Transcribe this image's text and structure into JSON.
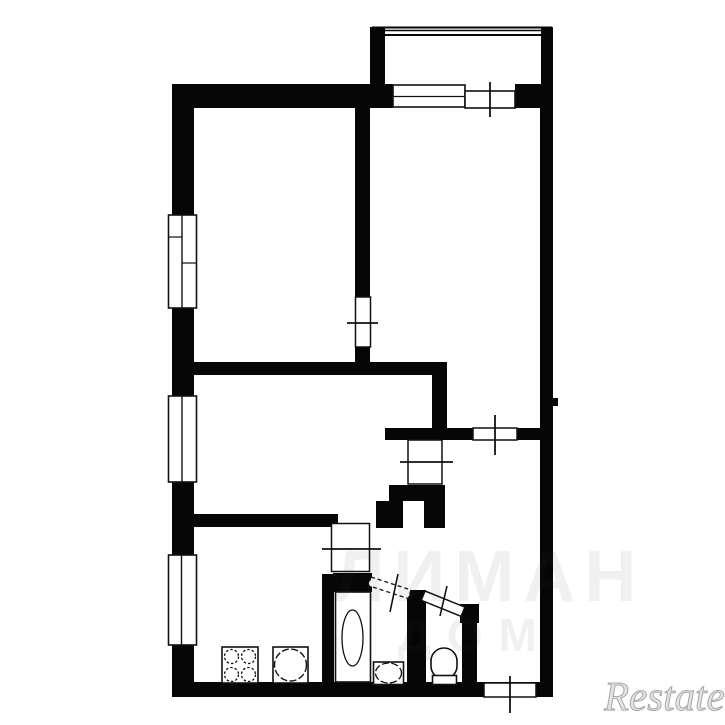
{
  "canvas": {
    "width": 725,
    "height": 725,
    "background": "#ffffff",
    "ink": "#060606",
    "line": "#111111"
  },
  "watermarks": {
    "center_line1": "ЛИМАН",
    "center_line2": "ДОМ",
    "logo": "Restate"
  },
  "plan": {
    "shapes": [
      {
        "name": "top-wall-left",
        "kind": "rect",
        "x": 172,
        "y": 84,
        "w": 221,
        "h": 24,
        "fill": "#060606"
      },
      {
        "name": "top-wall-right",
        "kind": "rect",
        "x": 515,
        "y": 84,
        "w": 38,
        "h": 24,
        "fill": "#060606"
      },
      {
        "name": "left-wall-upper",
        "kind": "rect",
        "x": 172,
        "y": 84,
        "w": 22,
        "h": 132,
        "fill": "#060606"
      },
      {
        "name": "left-wall-mid1",
        "kind": "rect",
        "x": 172,
        "y": 307,
        "w": 22,
        "h": 90,
        "fill": "#060606"
      },
      {
        "name": "left-wall-mid2",
        "kind": "rect",
        "x": 172,
        "y": 481,
        "w": 22,
        "h": 75,
        "fill": "#060606"
      },
      {
        "name": "left-wall-lower",
        "kind": "rect",
        "x": 172,
        "y": 644,
        "w": 22,
        "h": 53,
        "fill": "#060606"
      },
      {
        "name": "bottom-wall",
        "kind": "rect",
        "x": 172,
        "y": 682,
        "w": 381,
        "h": 15,
        "fill": "#060606"
      },
      {
        "name": "right-wall",
        "kind": "rect",
        "x": 540,
        "y": 84,
        "w": 13,
        "h": 598,
        "fill": "#060606"
      },
      {
        "name": "right-wall-nub",
        "kind": "rect",
        "x": 553,
        "y": 398,
        "w": 5,
        "h": 8,
        "fill": "#060606"
      },
      {
        "name": "balcony-wall-left",
        "kind": "rect",
        "x": 370,
        "y": 27,
        "w": 15,
        "h": 58,
        "fill": "#060606"
      },
      {
        "name": "balcony-wall-right",
        "kind": "rect",
        "x": 541,
        "y": 27,
        "w": 12,
        "h": 58,
        "fill": "#060606"
      },
      {
        "name": "bedroom-divider-wall",
        "kind": "rect",
        "x": 355,
        "y": 108,
        "w": 15,
        "h": 189,
        "fill": "#060606"
      },
      {
        "name": "bedroom-divider-stub",
        "kind": "rect",
        "x": 355,
        "y": 347,
        "w": 15,
        "h": 16,
        "fill": "#060606"
      },
      {
        "name": "hall-top-wall",
        "kind": "rect",
        "x": 193,
        "y": 362,
        "w": 254,
        "h": 13,
        "fill": "#060606"
      },
      {
        "name": "hall-vertical-wall",
        "kind": "rect",
        "x": 432,
        "y": 375,
        "w": 15,
        "h": 53,
        "fill": "#060606"
      },
      {
        "name": "hall-lower-wall-left",
        "kind": "rect",
        "x": 385,
        "y": 428,
        "w": 88,
        "h": 12,
        "fill": "#060606"
      },
      {
        "name": "hall-lower-wall-right",
        "kind": "rect",
        "x": 517,
        "y": 428,
        "w": 36,
        "h": 12,
        "fill": "#060606"
      },
      {
        "name": "corridor-wall",
        "kind": "rect",
        "x": 193,
        "y": 514,
        "w": 145,
        "h": 13,
        "fill": "#060606"
      },
      {
        "name": "duct-block",
        "kind": "rect",
        "x": 389,
        "y": 485,
        "w": 56,
        "h": 16,
        "fill": "#060606"
      },
      {
        "name": "duct-leg-left",
        "kind": "rect",
        "x": 376,
        "y": 501,
        "w": 27,
        "h": 27,
        "fill": "#060606"
      },
      {
        "name": "duct-leg-right",
        "kind": "rect",
        "x": 424,
        "y": 501,
        "w": 21,
        "h": 27,
        "fill": "#060606"
      },
      {
        "name": "kitchen-divider-wall",
        "kind": "rect",
        "x": 322,
        "y": 574,
        "w": 12,
        "h": 123,
        "fill": "#060606"
      },
      {
        "name": "bathroom-top-wall",
        "kind": "rect",
        "x": 333,
        "y": 573,
        "w": 39,
        "h": 19,
        "fill": "#060606"
      },
      {
        "name": "wc-left-wall",
        "kind": "rect",
        "x": 407,
        "y": 590,
        "w": 19,
        "h": 107,
        "fill": "#060606"
      },
      {
        "name": "wc-corner-block",
        "kind": "rect",
        "x": 460,
        "y": 604,
        "w": 19,
        "h": 19,
        "fill": "#060606"
      },
      {
        "name": "wc-right-wall",
        "kind": "rect",
        "x": 462,
        "y": 622,
        "w": 15,
        "h": 75,
        "fill": "#060606"
      },
      {
        "name": "balcony-rail-line",
        "kind": "line",
        "x1": 372,
        "y1": 27.5,
        "x2": 552,
        "y2": 27.5,
        "stroke": "#060606",
        "sw": 2
      },
      {
        "name": "balcony-rail-line",
        "kind": "line",
        "x1": 372,
        "y1": 30.5,
        "x2": 552,
        "y2": 30.5,
        "stroke": "#060606",
        "sw": 1.4
      },
      {
        "name": "balcony-rail-line",
        "kind": "line",
        "x1": 372,
        "y1": 35,
        "x2": 552,
        "y2": 35,
        "stroke": "#060606",
        "sw": 2
      },
      {
        "name": "window-left-1",
        "kind": "rect",
        "x": 168.5,
        "y": 215,
        "w": 28,
        "h": 93,
        "fill": "#ffffff",
        "stroke": "#111111",
        "sw": 1.6
      },
      {
        "name": "window-left-1-divider",
        "kind": "line",
        "x1": 182,
        "y1": 215,
        "x2": 182,
        "y2": 308,
        "stroke": "#111111",
        "sw": 1.4
      },
      {
        "name": "window-left-1-sash",
        "kind": "line",
        "x1": 168.5,
        "y1": 237,
        "x2": 182,
        "y2": 237,
        "stroke": "#111111",
        "sw": 1.2
      },
      {
        "name": "window-left-1-sash",
        "kind": "line",
        "x1": 182,
        "y1": 263,
        "x2": 196.5,
        "y2": 263,
        "stroke": "#111111",
        "sw": 1.2
      },
      {
        "name": "window-left-2",
        "kind": "rect",
        "x": 168.5,
        "y": 396,
        "w": 28,
        "h": 86,
        "fill": "#ffffff",
        "stroke": "#111111",
        "sw": 1.6
      },
      {
        "name": "window-left-2-divider",
        "kind": "line",
        "x1": 182,
        "y1": 396,
        "x2": 182,
        "y2": 482,
        "stroke": "#111111",
        "sw": 1.4
      },
      {
        "name": "window-left-3",
        "kind": "rect",
        "x": 168.5,
        "y": 555,
        "w": 28,
        "h": 90,
        "fill": "#ffffff",
        "stroke": "#111111",
        "sw": 1.6
      },
      {
        "name": "window-left-3-divider",
        "kind": "line",
        "x1": 181.5,
        "y1": 555,
        "x2": 181.5,
        "y2": 645,
        "stroke": "#111111",
        "sw": 1.4
      },
      {
        "name": "balcony-window",
        "kind": "rect",
        "x": 393,
        "y": 85,
        "w": 72,
        "h": 22,
        "fill": "#ffffff",
        "stroke": "#111111",
        "sw": 1.6
      },
      {
        "name": "balcony-window-midline",
        "kind": "line",
        "x1": 393,
        "y1": 96.5,
        "x2": 465,
        "y2": 96.5,
        "stroke": "#111111",
        "sw": 1.3
      },
      {
        "name": "balcony-window-side",
        "kind": "rect",
        "x": 465,
        "y": 91,
        "w": 50,
        "h": 17,
        "fill": "#ffffff",
        "stroke": "#111111",
        "sw": 1.6
      },
      {
        "name": "bedroom-door",
        "kind": "rect",
        "x": 355.5,
        "y": 297,
        "w": 15,
        "h": 50,
        "fill": "#ffffff",
        "stroke": "#111111",
        "sw": 1.5
      },
      {
        "name": "hall-door",
        "kind": "rect",
        "x": 473,
        "y": 428,
        "w": 44,
        "h": 12,
        "fill": "#ffffff",
        "stroke": "#111111",
        "sw": 1.5
      },
      {
        "name": "room-door",
        "kind": "rect",
        "x": 408,
        "y": 440,
        "w": 34,
        "h": 44,
        "fill": "#ffffff",
        "stroke": "#111111",
        "sw": 1.5
      },
      {
        "name": "kitchen-door",
        "kind": "rect",
        "x": 331.5,
        "y": 523.5,
        "w": 38,
        "h": 48,
        "fill": "#ffffff",
        "stroke": "#111111",
        "sw": 1.5
      },
      {
        "name": "entry-door",
        "kind": "rect",
        "x": 484,
        "y": 683,
        "w": 52,
        "h": 14,
        "fill": "#ffffff",
        "stroke": "#111111",
        "sw": 1.5
      },
      {
        "name": "bathroom-door-leaf",
        "kind": "rect",
        "x": 371,
        "y": 577,
        "w": 42,
        "h": 9,
        "fill": "#ffffff",
        "stroke": "#111111",
        "sw": 1.3,
        "dash": "4,3",
        "rot": 18
      },
      {
        "name": "wc-door-leaf",
        "kind": "rect",
        "x": 425,
        "y": 591,
        "w": 43,
        "h": 10,
        "fill": "#ffffff",
        "stroke": "#111111",
        "sw": 1.5,
        "rot": 22
      },
      {
        "name": "opening-tick",
        "kind": "line",
        "x1": 490,
        "y1": 82,
        "x2": 490,
        "y2": 117,
        "stroke": "#111111",
        "sw": 1.8
      },
      {
        "name": "opening-tick",
        "kind": "line",
        "x1": 347,
        "y1": 323,
        "x2": 378,
        "y2": 323,
        "stroke": "#111111",
        "sw": 1.8
      },
      {
        "name": "opening-tick",
        "kind": "line",
        "x1": 495,
        "y1": 415,
        "x2": 495,
        "y2": 455,
        "stroke": "#111111",
        "sw": 1.8
      },
      {
        "name": "opening-tick",
        "kind": "line",
        "x1": 400,
        "y1": 462,
        "x2": 453,
        "y2": 462,
        "stroke": "#111111",
        "sw": 1.8
      },
      {
        "name": "opening-tick",
        "kind": "line",
        "x1": 322,
        "y1": 549,
        "x2": 381,
        "y2": 549,
        "stroke": "#111111",
        "sw": 1.8
      },
      {
        "name": "opening-tick",
        "kind": "line",
        "x1": 510,
        "y1": 676,
        "x2": 510,
        "y2": 713,
        "stroke": "#111111",
        "sw": 1.8
      },
      {
        "name": "opening-tick",
        "kind": "line",
        "x1": 398,
        "y1": 574,
        "x2": 390,
        "y2": 612,
        "stroke": "#111111",
        "sw": 1.6
      },
      {
        "name": "opening-tick",
        "kind": "line",
        "x1": 447,
        "y1": 586,
        "x2": 440,
        "y2": 616,
        "stroke": "#111111",
        "sw": 1.6
      },
      {
        "name": "stove",
        "kind": "rect",
        "x": 222,
        "y": 647,
        "w": 36,
        "h": 36,
        "fill": "#ffffff",
        "stroke": "#111111",
        "sw": 1.6
      },
      {
        "name": "stove-burner",
        "kind": "circle",
        "cx": 231.5,
        "cy": 656.5,
        "r": 7,
        "stroke": "#111111",
        "sw": 1.3,
        "dash": "2.5,2"
      },
      {
        "name": "stove-burner",
        "kind": "circle",
        "cx": 248.5,
        "cy": 656.5,
        "r": 7,
        "stroke": "#111111",
        "sw": 1.3,
        "dash": "2.5,2"
      },
      {
        "name": "stove-burner",
        "kind": "circle",
        "cx": 231.5,
        "cy": 674.5,
        "r": 7,
        "stroke": "#111111",
        "sw": 1.3,
        "dash": "2.5,2"
      },
      {
        "name": "stove-burner",
        "kind": "circle",
        "cx": 248.5,
        "cy": 674.5,
        "r": 7,
        "stroke": "#111111",
        "sw": 1.3,
        "dash": "2.5,2"
      },
      {
        "name": "kitchen-sink",
        "kind": "rect",
        "x": 273,
        "y": 647,
        "w": 35,
        "h": 36,
        "fill": "#ffffff",
        "stroke": "#111111",
        "sw": 1.6
      },
      {
        "name": "kitchen-sink-bowl",
        "kind": "circle",
        "cx": 290.5,
        "cy": 665,
        "r": 16,
        "stroke": "#111111",
        "sw": 1.4,
        "dash": "7,2.5"
      },
      {
        "name": "bathtub",
        "kind": "rect",
        "x": 335.5,
        "y": 592,
        "w": 35,
        "h": 90,
        "fill": "#ffffff",
        "stroke": "#111111",
        "sw": 1.6
      },
      {
        "name": "bathtub-basin",
        "kind": "ellipse",
        "cx": 352.5,
        "cy": 638,
        "rx": 10.5,
        "ry": 28,
        "stroke": "#111111",
        "sw": 1.3
      },
      {
        "name": "bathroom-sink",
        "kind": "rect",
        "x": 373.5,
        "y": 662,
        "w": 30,
        "h": 22.5,
        "fill": "#ffffff",
        "stroke": "#111111",
        "sw": 1.6
      },
      {
        "name": "bathroom-sink-bowl",
        "kind": "ellipse",
        "cx": 388.5,
        "cy": 673,
        "rx": 13,
        "ry": 10,
        "stroke": "#111111",
        "sw": 1.3,
        "dash": "7,2.5"
      },
      {
        "name": "toilet-bowl",
        "kind": "rect",
        "x": 431,
        "y": 648,
        "w": 26,
        "h": 31,
        "rx": 13,
        "fill": "#ffffff",
        "stroke": "#111111",
        "sw": 1.6
      },
      {
        "name": "toilet-base",
        "kind": "rect",
        "x": 432.5,
        "y": 675.5,
        "w": 24,
        "h": 9,
        "fill": "#ffffff",
        "stroke": "#111111",
        "sw": 1.6
      }
    ]
  }
}
